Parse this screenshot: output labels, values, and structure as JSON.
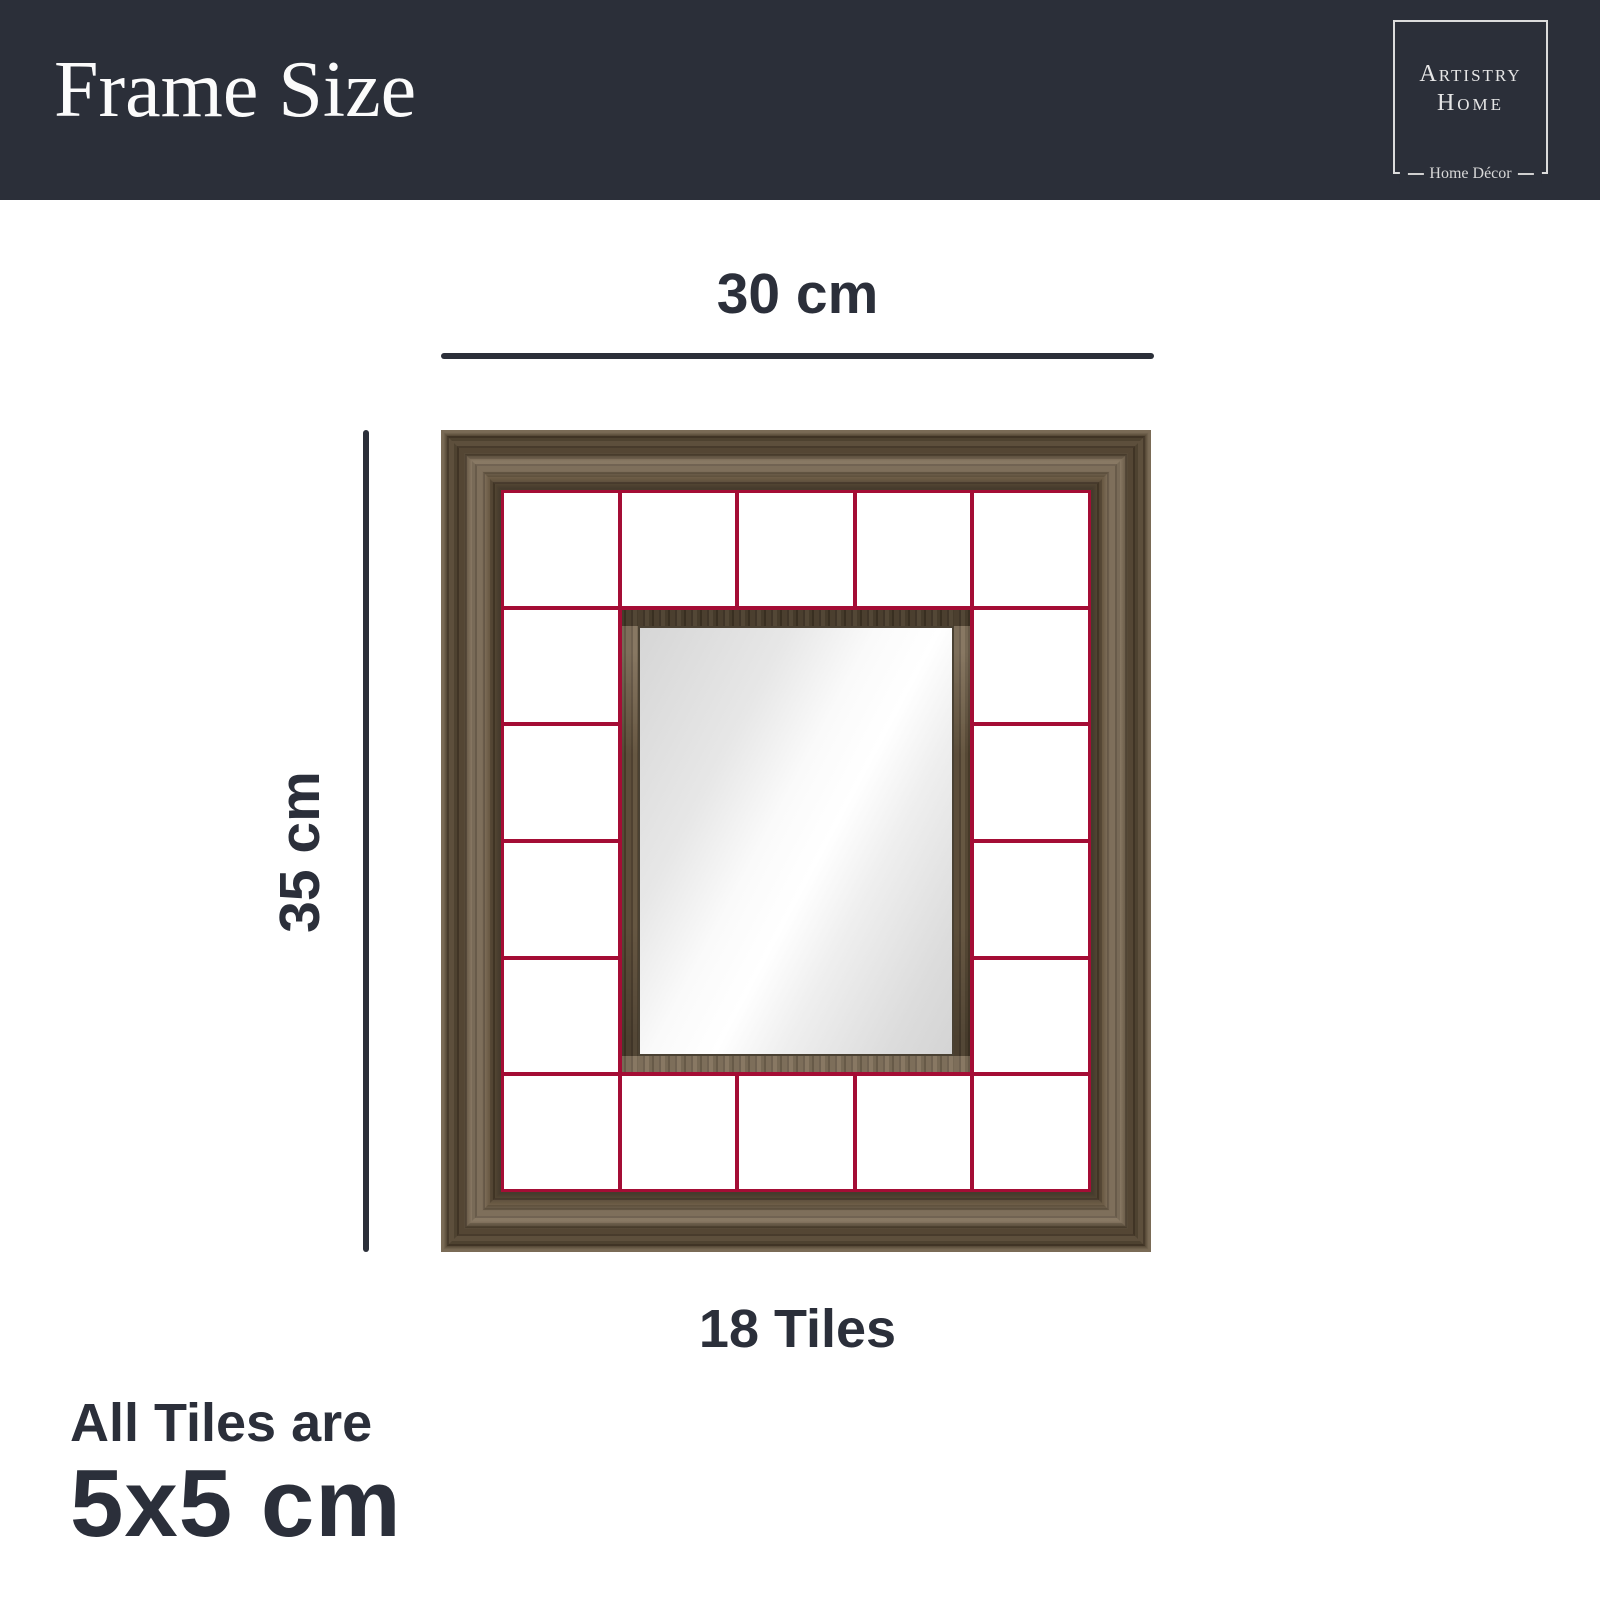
{
  "header": {
    "title": "Frame Size",
    "bg_color": "#2b2f39",
    "logo": {
      "name_line1": "Artistry",
      "name_line2": "Home",
      "tagline": "Home Décor"
    }
  },
  "diagram": {
    "width_label": "30 cm",
    "height_label": "35 cm",
    "tiles_label": "18 Tiles",
    "grid": {
      "columns": 5,
      "rows": 6,
      "tile_count": 18,
      "mirror_col_span": 3,
      "mirror_row_span": 4
    },
    "colors": {
      "grid_line_red": "#a40d35",
      "wood_brown": "#6b5a43",
      "dimension_ink": "#2b2f39",
      "mirror_light": "#ffffff",
      "mirror_gray": "#d6d6d6"
    }
  },
  "footer": {
    "line1": "All Tiles are",
    "line2": "5x5 cm"
  }
}
